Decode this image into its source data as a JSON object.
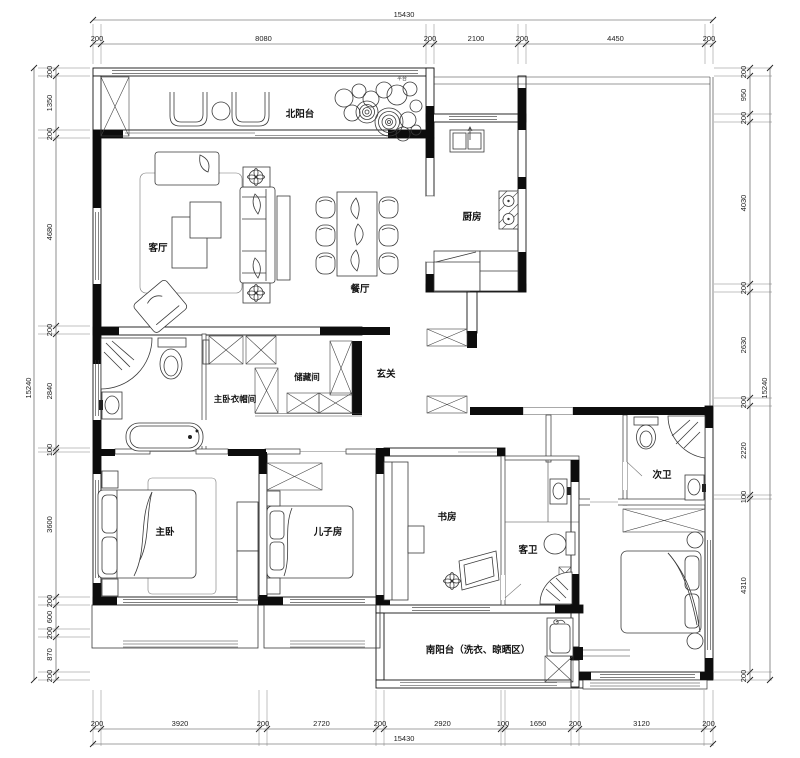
{
  "rooms": {
    "north_balcony": "北阳台",
    "living": "客厅",
    "dining": "餐厅",
    "kitchen": "厨房",
    "foyer": "玄关",
    "storage": "储藏间",
    "master_closet": "主卧衣帽间",
    "master_bedroom": "主卧",
    "sons_room": "儿子房",
    "study": "书房",
    "guest_bath": "客卫",
    "second_bath": "次卫",
    "south_balcony": "南阳台（洗衣、晾晒区）",
    "platform_note": "平台"
  },
  "dimensions_mm": {
    "top": {
      "total": "15430",
      "segments": [
        "200",
        "8080",
        "200",
        "2100",
        "200",
        "4450",
        "200"
      ]
    },
    "bottom": {
      "total": "15430",
      "segments": [
        "200",
        "3920",
        "200",
        "2720",
        "200",
        "2920",
        "100",
        "1650",
        "200",
        "3120",
        "200"
      ]
    },
    "left": {
      "total": "15240",
      "segments": [
        "200",
        "1350",
        "200",
        "4680",
        "200",
        "2840",
        "100",
        "3600",
        "200",
        "600",
        "200",
        "870",
        "200"
      ]
    },
    "right": {
      "total": "15240",
      "segments": [
        "200",
        "950",
        "200",
        "4030",
        "200",
        "2630",
        "200",
        "2220",
        "100",
        "4310",
        "200"
      ]
    }
  }
}
